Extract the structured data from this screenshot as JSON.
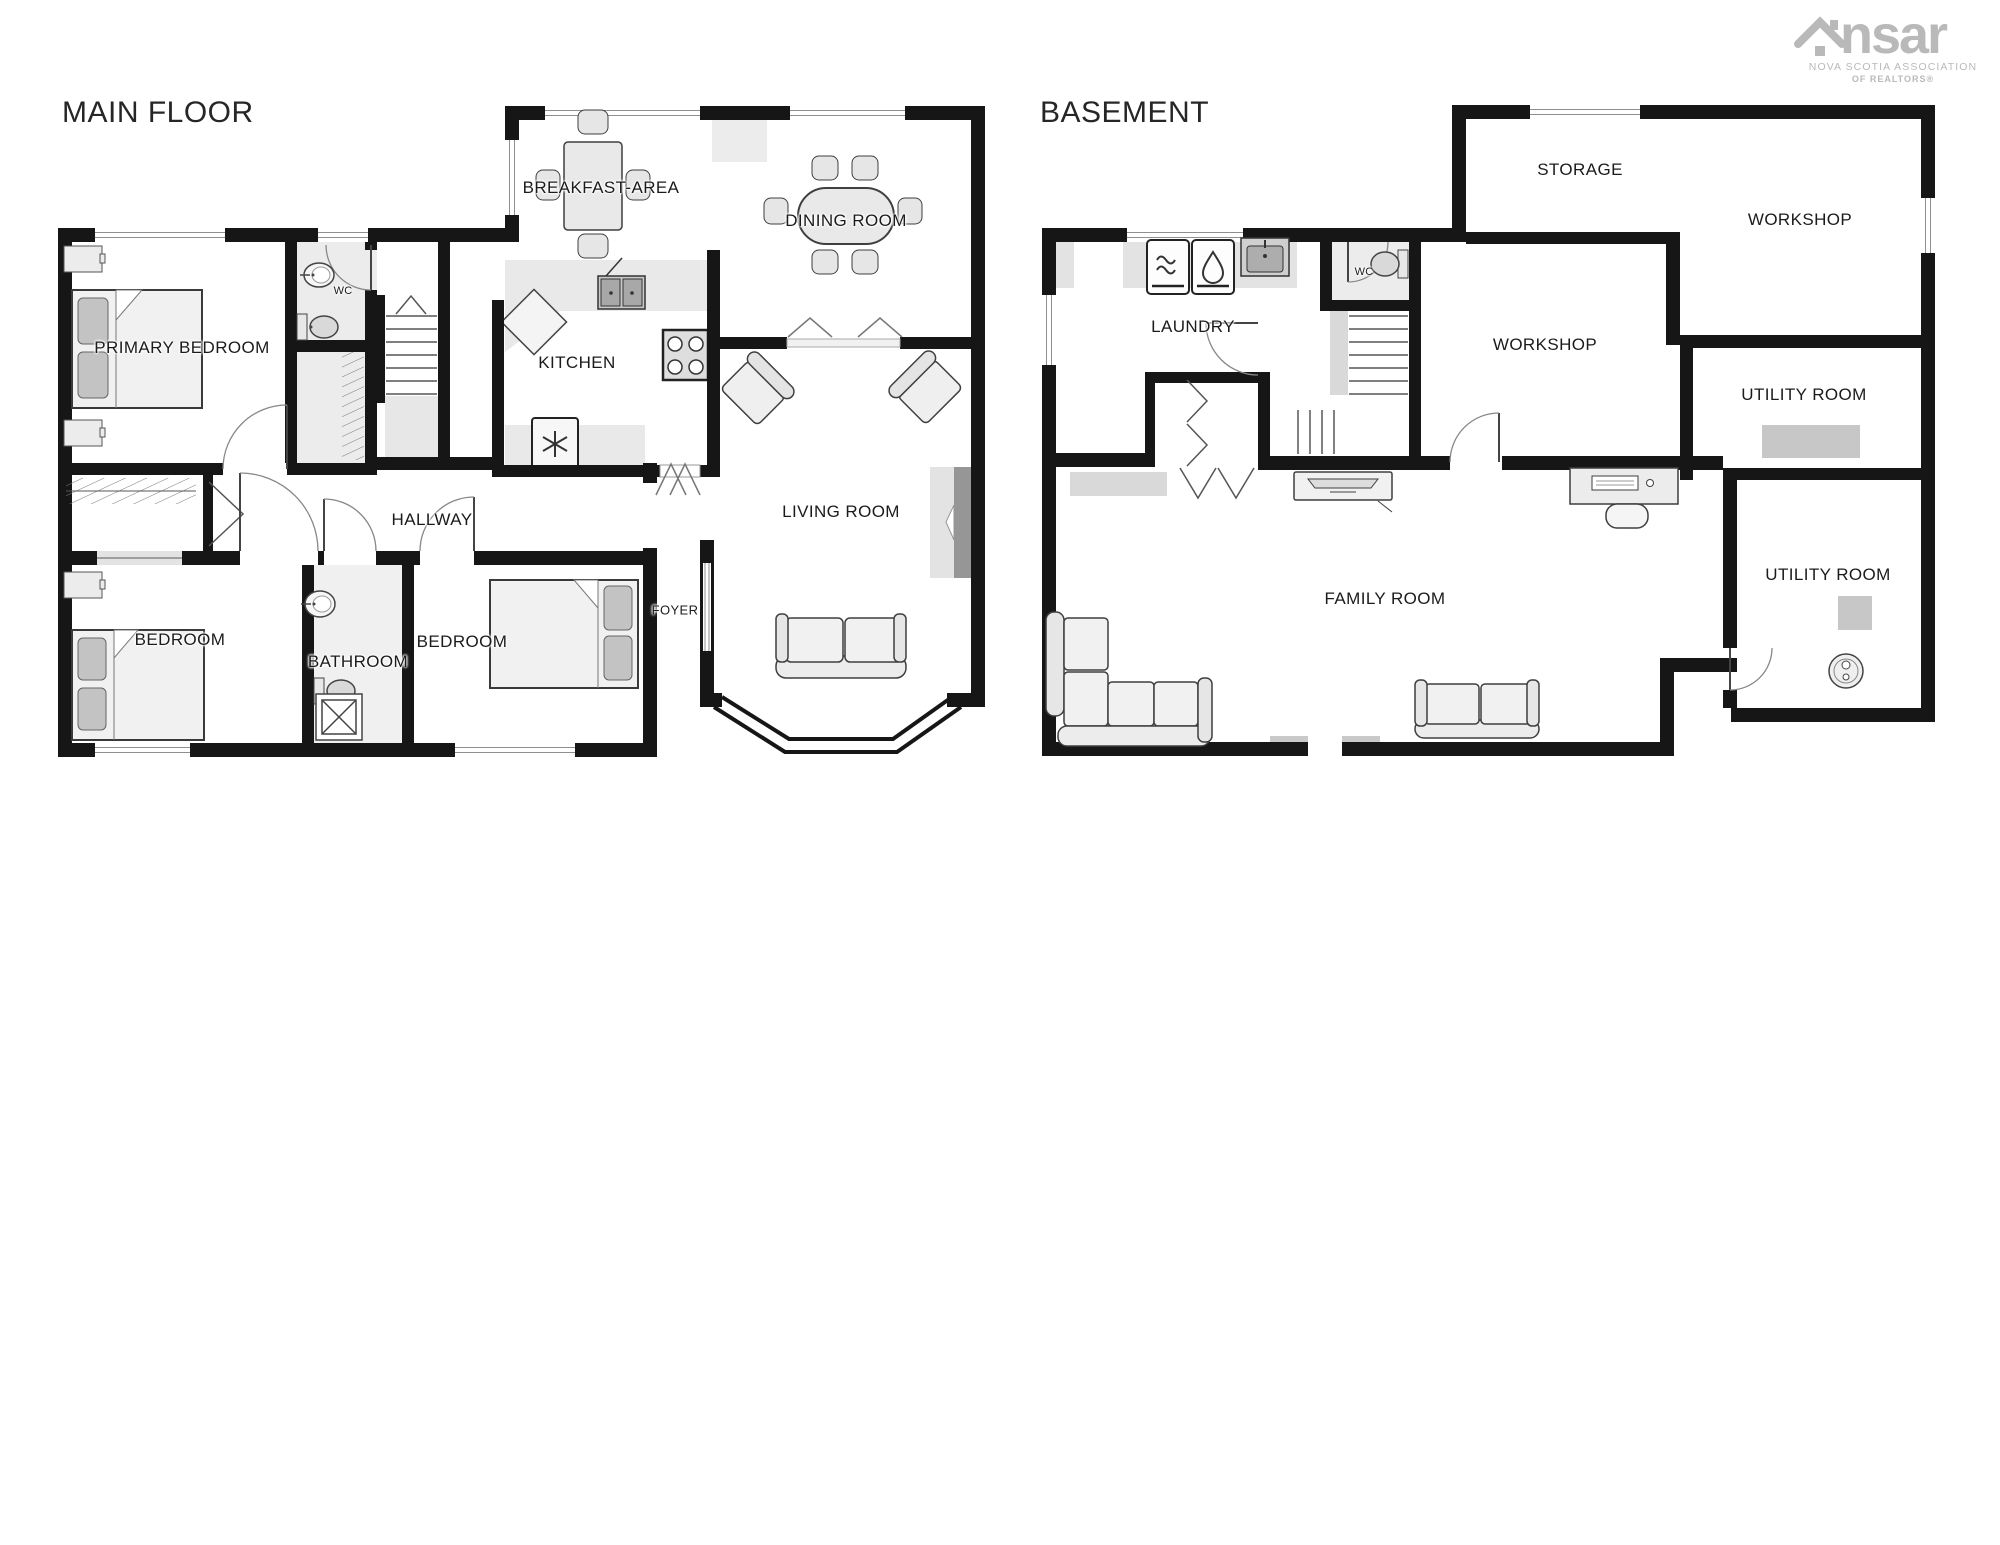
{
  "page": {
    "width": 2000,
    "height": 1545,
    "background": "#ffffff"
  },
  "logo": {
    "word_left": "ns",
    "word_right": "ar",
    "line1": "NOVA SCOTIA ASSOCIATION",
    "line2": "OF REALTORS®",
    "color": "#b9b9b9"
  },
  "main_floor": {
    "title": "MAIN FLOOR",
    "labels": {
      "primary_bedroom": "PRIMARY BEDROOM",
      "wc": "WC",
      "hallway": "HALLWAY",
      "bedroom_left": "BEDROOM",
      "bathroom": "BATHROOM",
      "bedroom_right": "BEDROOM",
      "kitchen": "KITCHEN",
      "breakfast_area": "BREAKFAST-AREA",
      "dining_room": "DINING ROOM",
      "living_room": "LIVING ROOM",
      "foyer": "FOYER"
    }
  },
  "basement": {
    "title": "BASEMENT",
    "labels": {
      "laundry": "LAUNDRY",
      "wc": "WC",
      "storage": "STORAGE",
      "workshop_right": "WORKSHOP",
      "workshop_left": "WORKSHOP",
      "utility_room_upper": "UTILITY ROOM",
      "family_room": "FAMILY ROOM",
      "utility_room_lower": "UTILITY ROOM"
    }
  },
  "colors": {
    "wall": "#161616",
    "door_arc": "#777777",
    "furniture_stroke": "#3f3f3f",
    "furniture_fill": "#f1f1f1",
    "floor_shade": "#ececec",
    "appliance": "#b5b5b5",
    "label": "#1b1b1b"
  }
}
